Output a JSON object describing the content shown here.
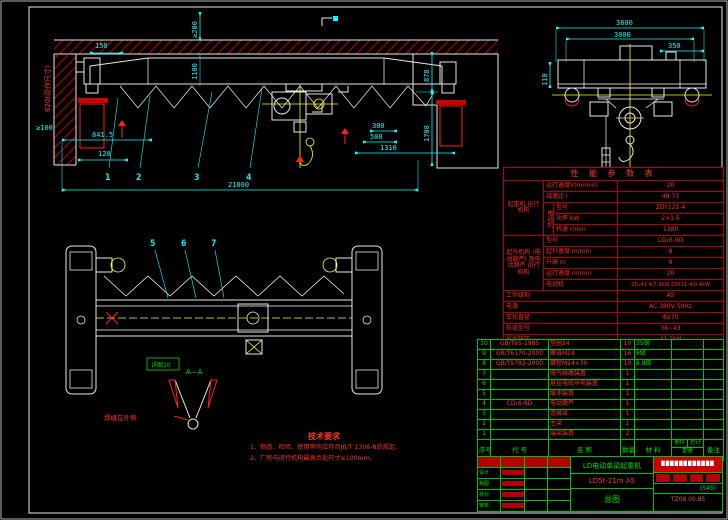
{
  "front_view": {
    "dim_150": "150",
    "dim_ge200": "≥200",
    "dim_1100": "1100",
    "dim_620": "620(动作尺寸)",
    "dim_ge100": "≥100",
    "dim_8415": "841.5",
    "dim_120": "120",
    "dim_21000": "21000",
    "dim_878": "878",
    "dim_1708": "1708",
    "dim_300": "300",
    "dim_500": "500",
    "dim_1310": "1310",
    "balloon_1": "1",
    "balloon_2": "2",
    "balloon_3": "3",
    "balloon_4": "4"
  },
  "end_view": {
    "dim_3600": "3600",
    "dim_3000": "3000",
    "dim_350": "350",
    "dim_110": "110"
  },
  "plan_view": {
    "balloon_5": "5",
    "balloon_6": "6",
    "balloon_7": "7",
    "detail_box_label": "详图10",
    "section_label": "A—A",
    "weld_note": "焊缝在外侧"
  },
  "notes": {
    "title": "技术要求",
    "item_1": "1、制造、检验、使用等均应符合JB/T 1306-8的规定。",
    "item_2": "2、厂房与运行机构最高点处尺寸≥100mm。"
  },
  "param_table": {
    "title": "性 能 参 数 表",
    "group_travel": "起重机 运行机构",
    "row_speed_label": "运行速度V(m/min)",
    "row_speed_value": "20",
    "row_ratio_label": "减速比 i",
    "row_ratio_value": "48.73",
    "motor_group": "电动机",
    "row_model_label": "型号",
    "row_model_value": "ZDY121-4",
    "row_power_label": "功率 kW",
    "row_power_value": "2×1.5",
    "row_rpm_label": "转速 r/min",
    "row_rpm_value": "1380",
    "group_hoist": "起升机构 (电动葫芦) 及电动葫芦 运行机构",
    "row_hmodel_label": "型号",
    "row_hmodel_value": "CD₁6-9D",
    "row_hspeed_label": "起升速度 m/min",
    "row_hspeed_value": "8",
    "row_hlift_label": "升高 m",
    "row_hlift_value": "9",
    "row_htravel_label": "运行速度 m/min",
    "row_htravel_value": "20",
    "row_hmotor_label": "电动机",
    "row_hmotor_value": "ZD₁41-4/7.5kW ZDY21-4/0.4kW",
    "row_duty_label": "工作级别",
    "row_duty_value": "A5",
    "row_supply_label": "电源",
    "row_supply_value": "AC 380V 50Hz",
    "row_wheel_label": "车轮直径",
    "row_wheel_value": "Φ270",
    "row_rail_label": "轨道型号",
    "row_rail_value": "38~43",
    "row_load_label": "最大轮压",
    "row_load_value": "41.7kN"
  },
  "bom": {
    "h_no": "序号",
    "h_code": "代 号",
    "h_name": "名 称",
    "h_qty": "数量",
    "h_mat": "材 料",
    "h_unit": "单件",
    "h_total": "总计",
    "h_weight": "重量",
    "h_note": "备注",
    "rows": [
      {
        "no": "10",
        "code": "GB/T95-1985",
        "name": "垫圈24",
        "qty": "10",
        "mat": "35钢"
      },
      {
        "no": "9",
        "code": "GB/T6170-2000",
        "name": "螺母M24",
        "qty": "16",
        "mat": "8级"
      },
      {
        "no": "8",
        "code": "GB/T5782-2000",
        "name": "螺栓M24×70",
        "qty": "10",
        "mat": "8.8级"
      },
      {
        "no": "7",
        "code": "",
        "name": "电气线路装置",
        "qty": "1",
        "mat": ""
      },
      {
        "no": "6",
        "code": "",
        "name": "悬挂电缆导电装置",
        "qty": "1",
        "mat": ""
      },
      {
        "no": "5",
        "code": "",
        "name": "缓冲装置",
        "qty": "1",
        "mat": ""
      },
      {
        "no": "4",
        "code": "CD₁6-9D",
        "name": "电动葫芦",
        "qty": "1",
        "mat": ""
      },
      {
        "no": "3",
        "code": "",
        "name": "连接梁",
        "qty": "1",
        "mat": ""
      },
      {
        "no": "2",
        "code": "",
        "name": "主梁",
        "qty": "1",
        "mat": ""
      },
      {
        "no": "1",
        "code": "",
        "name": "端梁装置",
        "qty": "2",
        "mat": ""
      }
    ]
  },
  "title_block": {
    "product": "LD电动单梁起重机",
    "model": "LD5t-21m A5",
    "sheet": "总图",
    "company": "████████████",
    "sig_labels": [
      "设计",
      "制图",
      "校对",
      "审核"
    ],
    "qty_mark": "(545)",
    "doc_no": "TZ08 00.85"
  }
}
